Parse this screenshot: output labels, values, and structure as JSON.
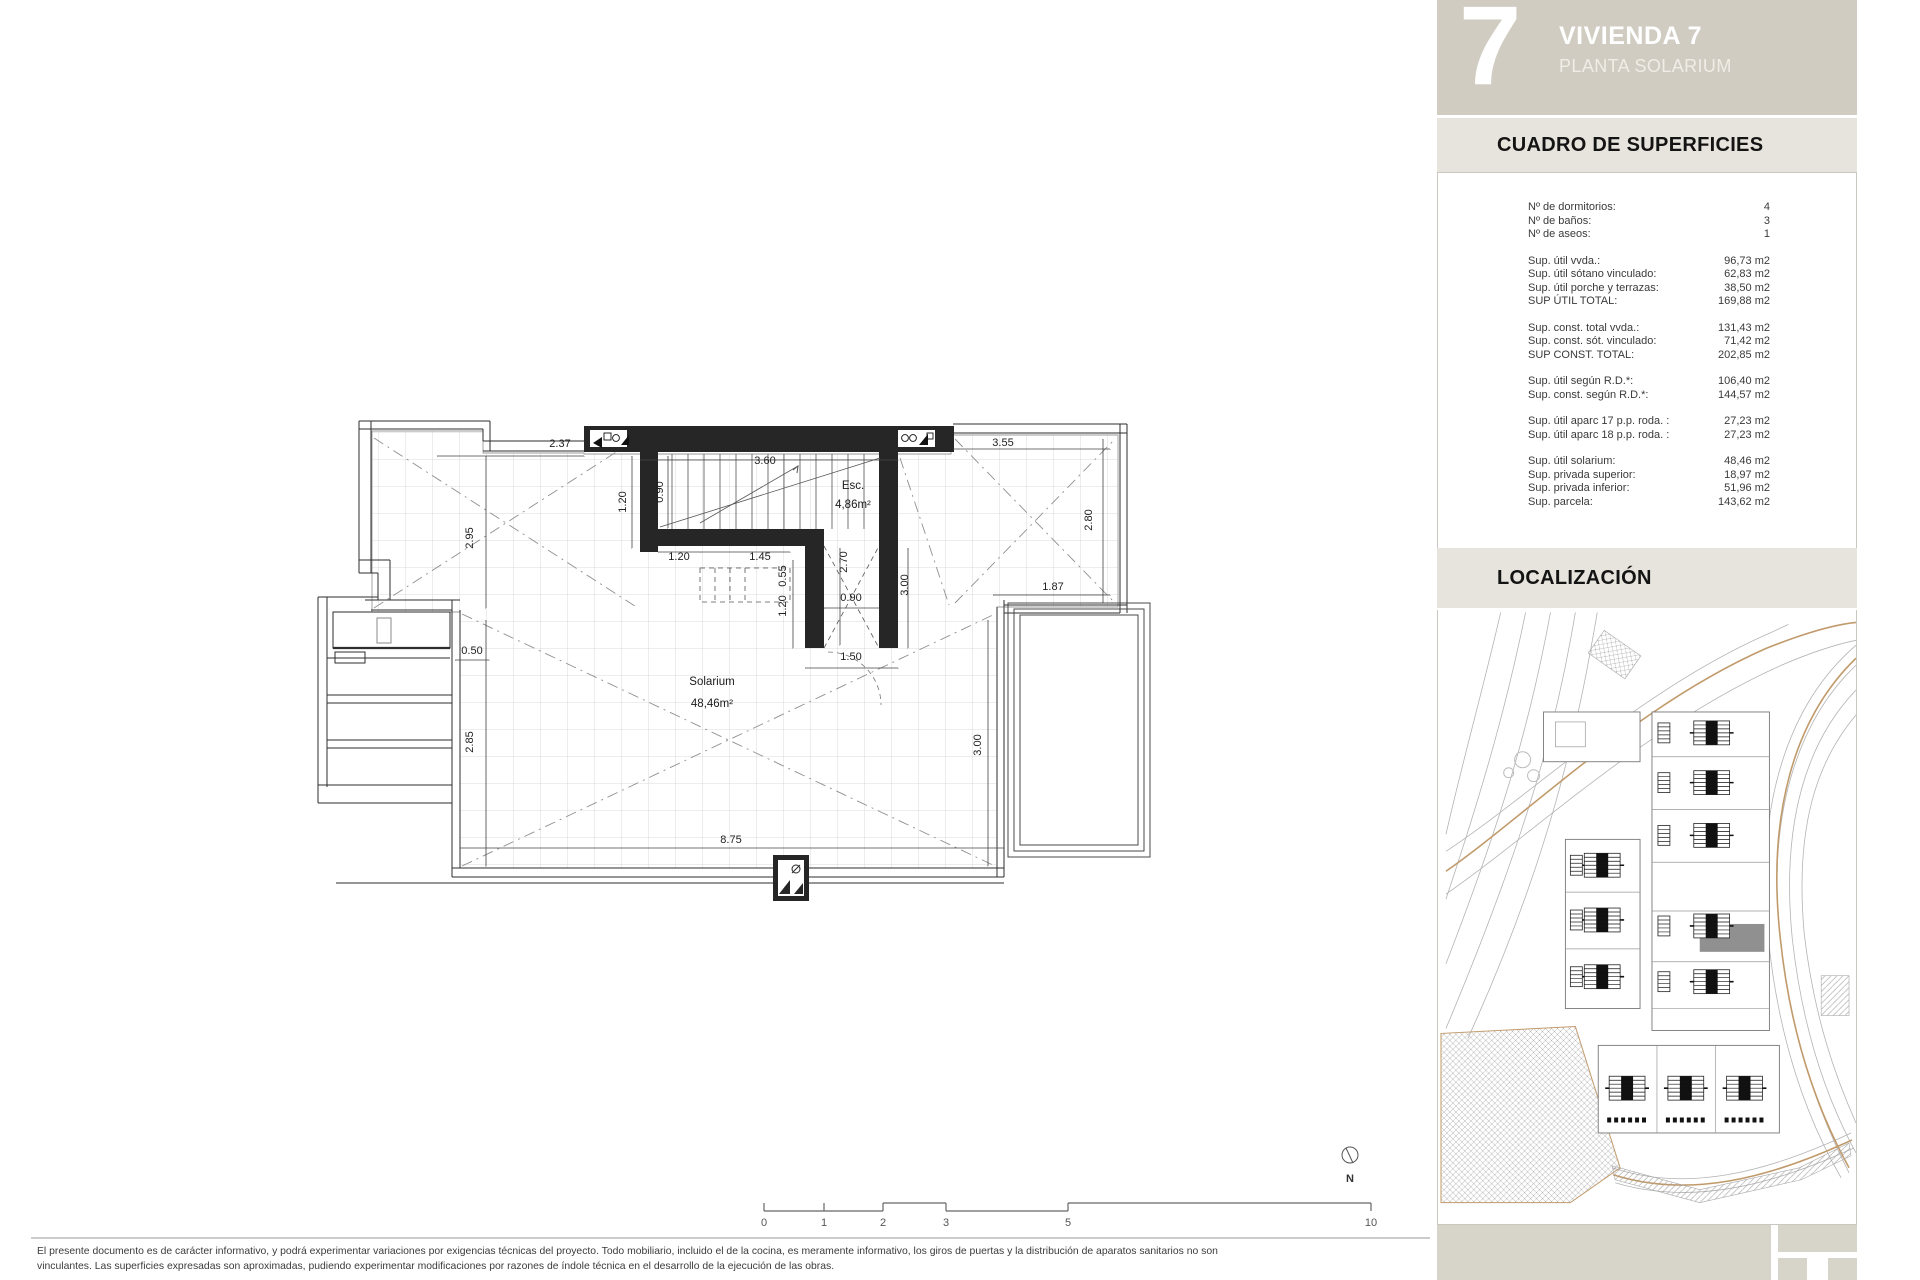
{
  "sidebar": {
    "unit_number": "7",
    "title": "VIVIENDA 7",
    "subtitle": "PLANTA SOLARIUM",
    "section_superficies": "CUADRO DE SUPERFICIES",
    "section_localizacion": "LOCALIZACIÓN",
    "colors": {
      "header_bg": "#d0ccc2",
      "section_bg": "#e6e4dc",
      "footer_bg": "#d7d4ca",
      "highlight_unit": "#909090"
    },
    "table": {
      "groups": [
        [
          {
            "label": "Nº de dormitorios:",
            "value": "4"
          },
          {
            "label": "Nº de baños:",
            "value": "3"
          },
          {
            "label": "Nº de aseos:",
            "value": "1"
          }
        ],
        [
          {
            "label": "Sup. útil vvda.:",
            "value": "96,73 m2"
          },
          {
            "label": "Sup. útil sótano vinculado:",
            "value": "62,83 m2"
          },
          {
            "label": "Sup. útil porche y terrazas:",
            "value": "38,50 m2"
          },
          {
            "label": "SUP ÚTIL TOTAL:",
            "value": "169,88 m2"
          }
        ],
        [
          {
            "label": "Sup. const. total vvda.:",
            "value": "131,43 m2"
          },
          {
            "label": "Sup. const. sót. vinculado:",
            "value": "71,42 m2"
          },
          {
            "label": "SUP CONST. TOTAL:",
            "value": "202,85 m2"
          }
        ],
        [
          {
            "label": "Sup. útil según R.D.*:",
            "value": "106,40 m2"
          },
          {
            "label": "Sup. const. según R.D.*:",
            "value": "144,57 m2"
          }
        ],
        [
          {
            "label": "Sup. útil aparc 17 p.p. roda. :",
            "value": "27,23 m2"
          },
          {
            "label": "Sup. útil aparc 18 p.p. roda. :",
            "value": "27,23 m2"
          }
        ],
        [
          {
            "label": "Sup. útil solarium:",
            "value": "48,46 m2"
          },
          {
            "label": "Sup. privada superior:",
            "value": "18,97 m2"
          },
          {
            "label": "Sup. privada inferior:",
            "value": "51,96 m2"
          },
          {
            "label": "Sup. parcela:",
            "value": "143,62 m2"
          }
        ]
      ]
    }
  },
  "plan": {
    "room_labels": [
      {
        "t": "Esc.",
        "x": 853,
        "y": 489
      },
      {
        "t": "4,86m²",
        "x": 853,
        "y": 508
      },
      {
        "t": "Solarium",
        "x": 712,
        "y": 685
      },
      {
        "t": "48,46m²",
        "x": 712,
        "y": 707
      }
    ],
    "dimensions": [
      {
        "t": "2.37",
        "x": 560,
        "y": 447
      },
      {
        "t": "3.60",
        "x": 765,
        "y": 464
      },
      {
        "t": "3.55",
        "x": 1003,
        "y": 446
      },
      {
        "t": "1.20",
        "x": 626,
        "y": 502,
        "r": -90
      },
      {
        "t": "0.90",
        "x": 663,
        "y": 492,
        "r": -90
      },
      {
        "t": "2.95",
        "x": 473,
        "y": 538,
        "r": -90
      },
      {
        "t": "2.85",
        "x": 473,
        "y": 742,
        "r": -90
      },
      {
        "t": "1.20",
        "x": 679,
        "y": 560
      },
      {
        "t": "1.45",
        "x": 760,
        "y": 560
      },
      {
        "t": "0.55",
        "x": 786,
        "y": 576,
        "r": -90
      },
      {
        "t": "2.70",
        "x": 847,
        "y": 562,
        "r": -90
      },
      {
        "t": "3.00",
        "x": 908,
        "y": 585,
        "r": -90
      },
      {
        "t": "2.80",
        "x": 1092,
        "y": 520,
        "r": -90
      },
      {
        "t": "1.87",
        "x": 1053,
        "y": 590
      },
      {
        "t": "3.00",
        "x": 981,
        "y": 745,
        "r": -90
      },
      {
        "t": "0.50",
        "x": 472,
        "y": 654
      },
      {
        "t": "8.75",
        "x": 731,
        "y": 843
      },
      {
        "t": "1.20",
        "x": 786,
        "y": 606,
        "r": -90
      },
      {
        "t": "0.90",
        "x": 851,
        "y": 601
      },
      {
        "t": "1.50",
        "x": 851,
        "y": 660
      }
    ]
  },
  "scalebar": {
    "ticks": [
      {
        "label": "0",
        "x": 764
      },
      {
        "label": "1",
        "x": 824
      },
      {
        "label": "2",
        "x": 883
      },
      {
        "label": "3",
        "x": 946
      },
      {
        "label": "5",
        "x": 1068
      },
      {
        "label": "10",
        "x": 1371
      }
    ]
  },
  "north": {
    "label": "N"
  },
  "footer": {
    "line1": "El presente documento es de carácter informativo, y podrá experimentar variaciones por exigencias técnicas del proyecto. Todo mobiliario, incluido el de la cocina, es meramente informativo, los giros de puertas y la distribución de aparatos sanitarios no son",
    "line2": "vinculantes. Las superficies expresadas son aproximadas, pudiendo experimentar modificaciones por razones de índole técnica en el desarrollo de la ejecución de las obras."
  }
}
